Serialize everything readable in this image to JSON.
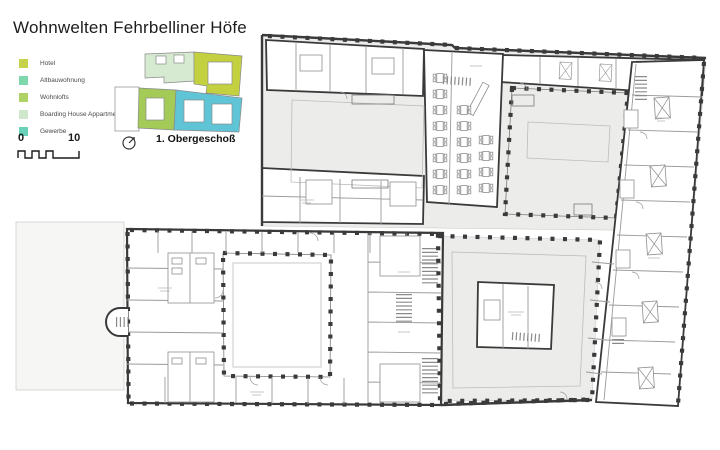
{
  "title": "Wohnwelten Fehrbelliner Höfe",
  "legend": [
    {
      "label": "Hotel",
      "color": "#c6d24a"
    },
    {
      "label": "Altbauwohnung",
      "color": "#7ed8ab"
    },
    {
      "label": "Wohnlofts",
      "color": "#afd266"
    },
    {
      "label": "Boarding House Appartments",
      "color": "#cfe7ca"
    },
    {
      "label": "Gewerbe",
      "color": "#68d1b8"
    }
  ],
  "scale_bar": {
    "start": "0",
    "end": "10"
  },
  "floor_label": "1. Obergeschoß",
  "icons": {
    "north": "north-arrow-icon"
  },
  "keyplan_colors": {
    "hotel": "#c3d140",
    "wohnlofts": "#a4cb57",
    "boarding_house": "#d6e9d1",
    "altbau_gewerbe": "#5fc5d6",
    "plot": "#ffffff"
  },
  "plan_colors": {
    "wall": "#3a3a3a",
    "slab": "#ecedea",
    "partition": "#9a9a9a",
    "courtyard_inset": "#bcbcbc"
  }
}
